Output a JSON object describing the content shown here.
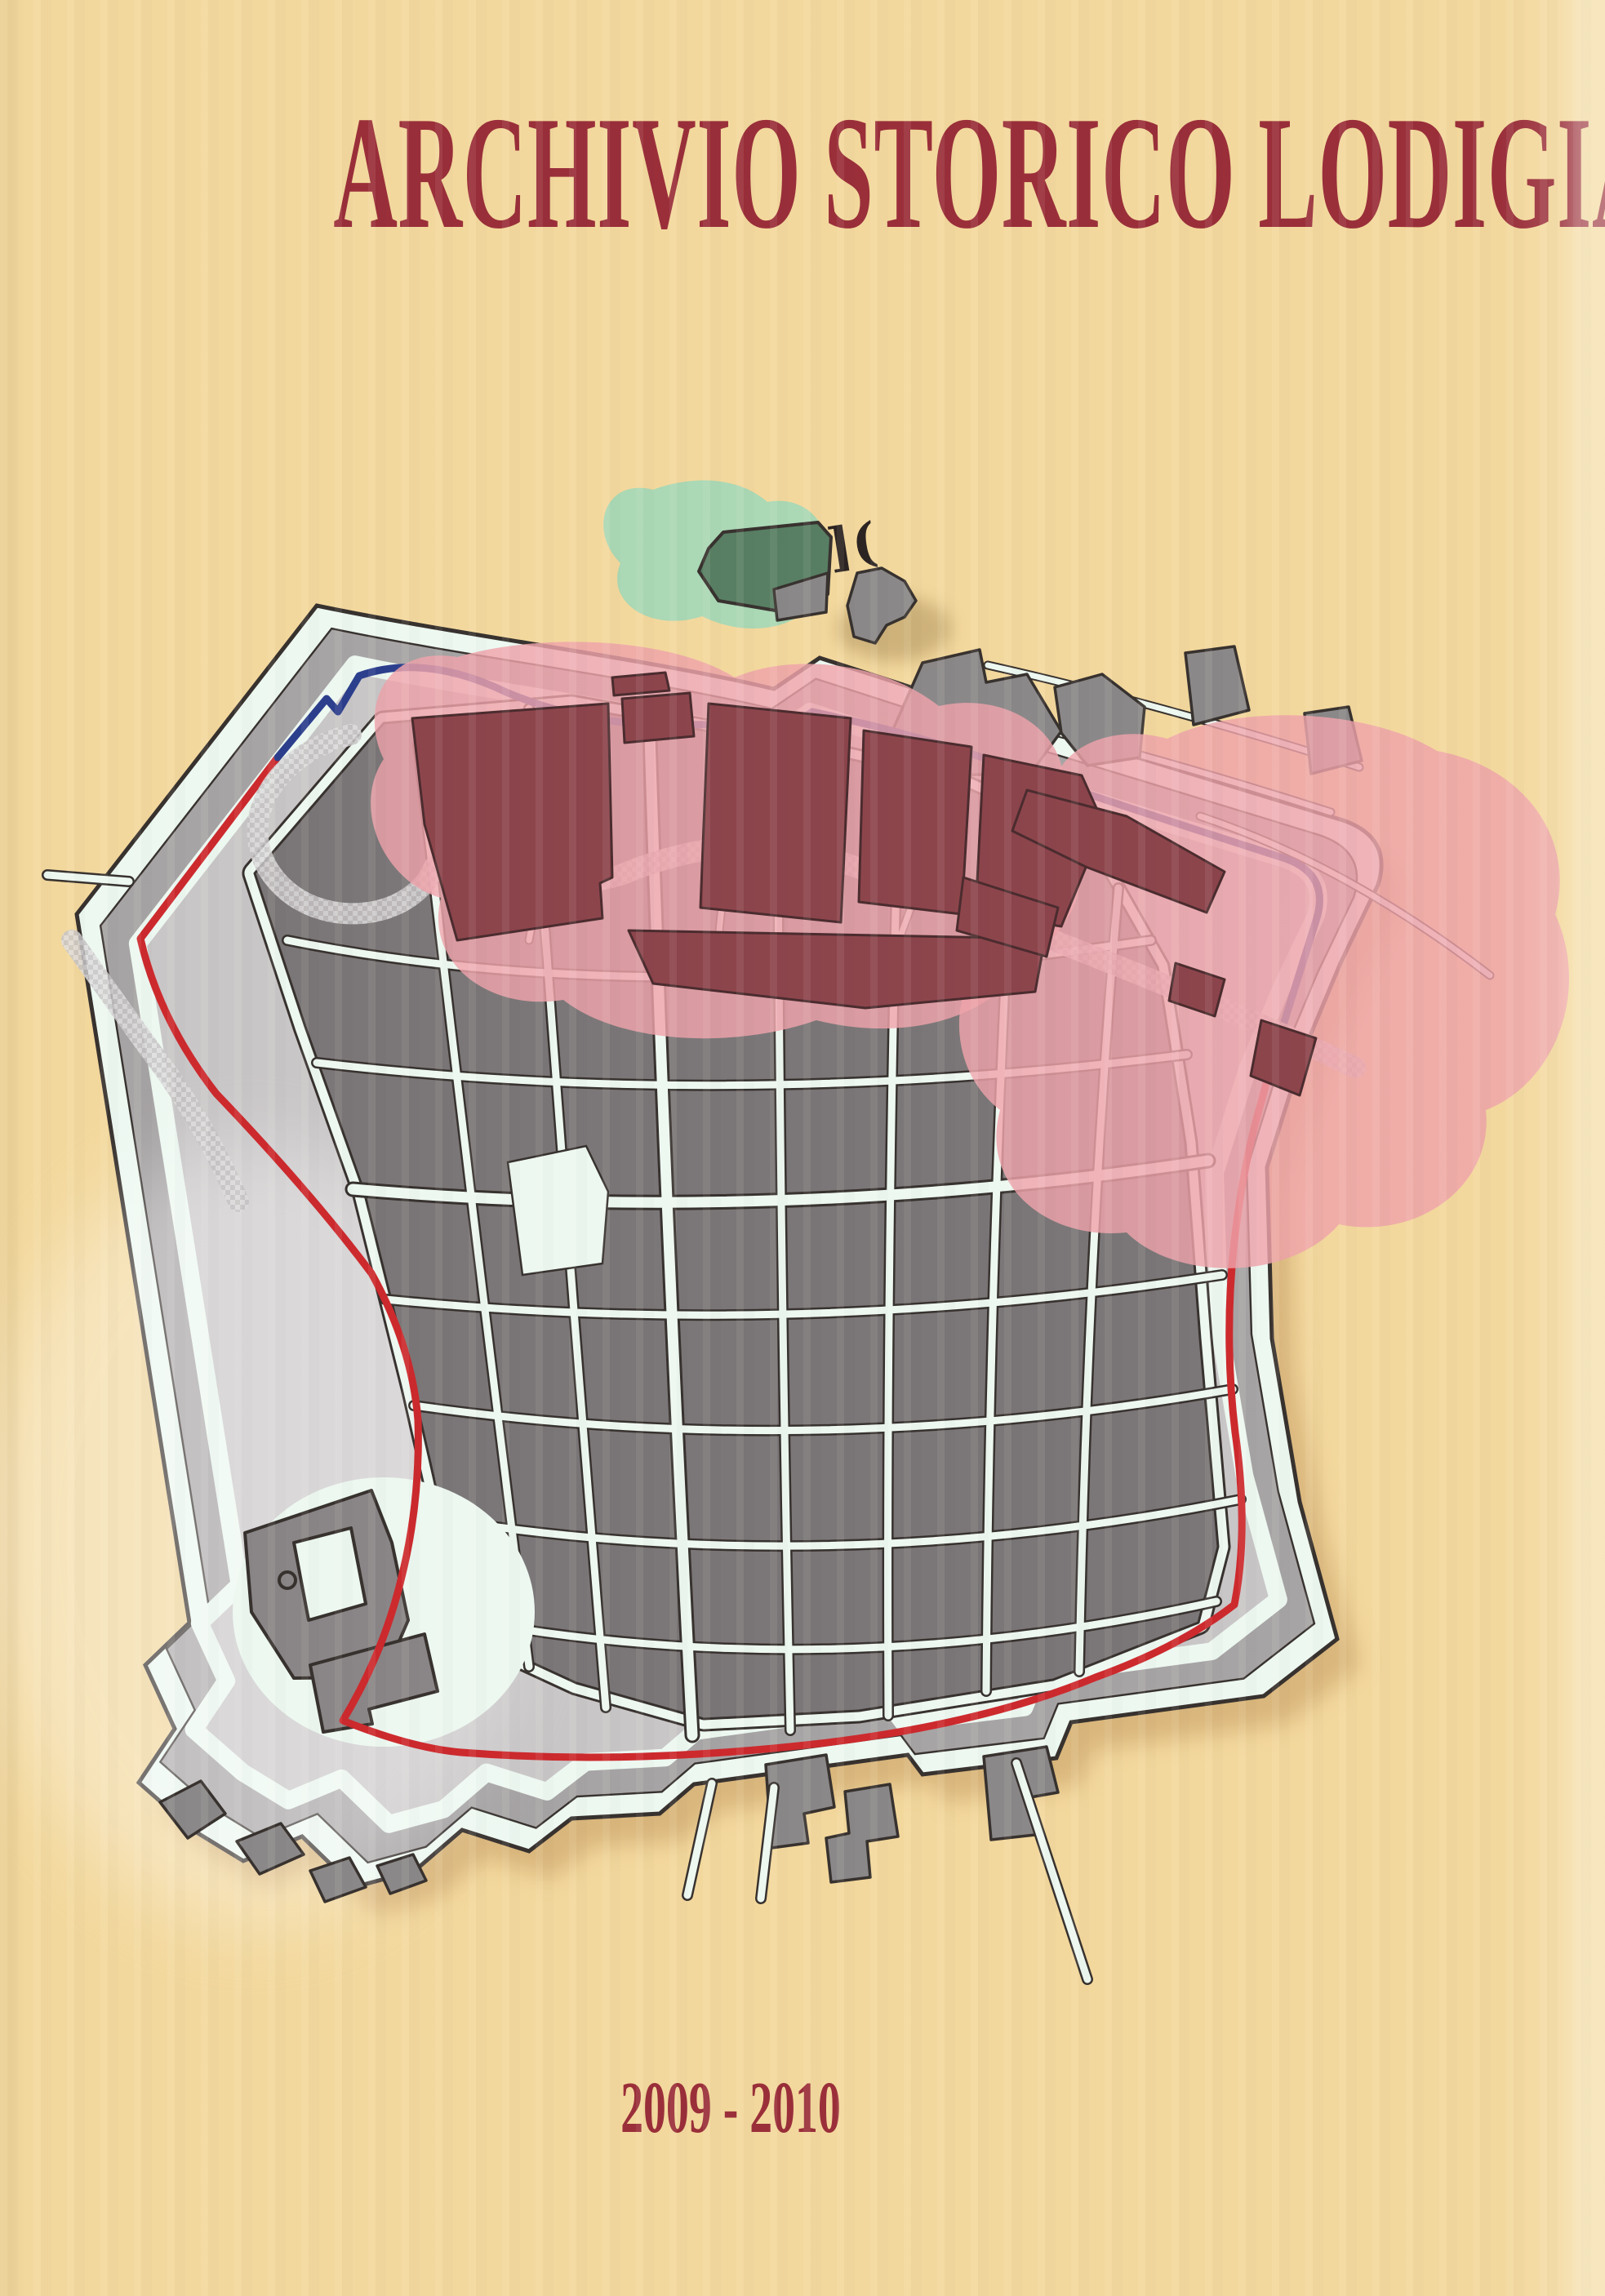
{
  "cover": {
    "title": "ARCHIVIO STORICO LODIGIANO",
    "years": "2009 - 2010"
  },
  "map": {
    "gate_marks": "]("
  },
  "colors": {
    "page_background": "#f3d89d",
    "title_text": "#9a2f3a",
    "date_text": "#9a2f3a",
    "map_outline": "#38322f",
    "wall_band_gray": "#a7a4a5",
    "open_land_gray": "#c9c6c7",
    "street_white": "#edf8f1",
    "block_gray": "#7b7778",
    "wall_circuit_red": "#cd2a2e",
    "river_blue": "#2c3f8d",
    "highlight_pink": "#efa3ab",
    "highlight_maroon": "#8d454c",
    "park_green": "#a6d8b6",
    "building_green": "#587f63",
    "outside_building_gray": "#8b8889",
    "castle_gray": "#8a8687",
    "map_shadow": "#c0955c"
  }
}
